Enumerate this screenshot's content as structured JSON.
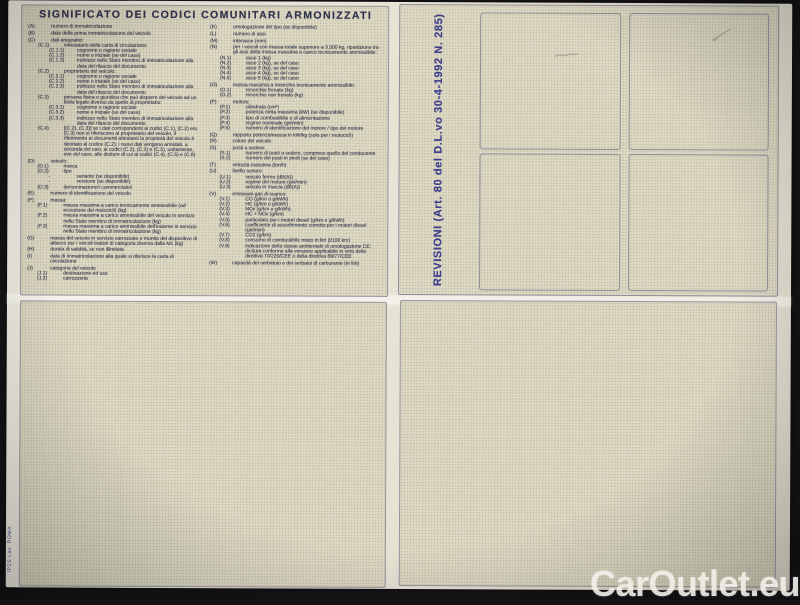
{
  "legend": {
    "title": "SIGNIFICATO DEI CODICI COMUNITARI ARMONIZZATI",
    "left_column": [
      {
        "code": "(A)",
        "text": "numero di immatricolazione",
        "indent": 0
      },
      {
        "code": "(B)",
        "text": "data della prima immatricolazione del veicolo",
        "indent": 0
      },
      {
        "code": "(C)",
        "text": "dati anagrafici:",
        "indent": 0
      },
      {
        "code": "(C.1)",
        "text": "intestatario della carta di circolazione:",
        "indent": 1
      },
      {
        "code": "(C.1.1)",
        "text": "cognome o ragione sociale",
        "indent": 2
      },
      {
        "code": "(C.1.2)",
        "text": "nome o iniziale (se del caso)",
        "indent": 2
      },
      {
        "code": "(C.1.3)",
        "text": "indirizzo nello Stato membro di immatricolazione alla data del rilascio del documento",
        "indent": 2
      },
      {
        "code": "(C.2)",
        "text": "proprietario del veicolo:",
        "indent": 1
      },
      {
        "code": "(C.2.1)",
        "text": "cognome o ragione sociale",
        "indent": 2
      },
      {
        "code": "(C.2.2)",
        "text": "nome o iniziale (se del caso)",
        "indent": 2
      },
      {
        "code": "(C.2.3)",
        "text": "indirizzo nello Stato membro di immatricolazione alla data del rilascio del documento",
        "indent": 2
      },
      {
        "code": "(C.3)",
        "text": "persona fisica o giuridica che può disporre del veicolo ad un titolo legale diverso da quello di proprietario:",
        "indent": 1
      },
      {
        "code": "(C.3.1)",
        "text": "cognome o ragione sociale",
        "indent": 2
      },
      {
        "code": "(C.3.2)",
        "text": "nome o iniziale (se del caso)",
        "indent": 2
      },
      {
        "code": "(C.3.3)",
        "text": "indirizzo nello Stato membro di immatricolazione alla data del rilascio del documento",
        "indent": 2
      },
      {
        "code": "(C.4)",
        "text": "[(C.2), (C.3)] se i dati corrispondenti ai codici (C.1), (C.2) e/o (C.3) non si riferiscono al proprietario del veicolo, il riferimento ai documenti attestanti la proprietà del veicolo è riportato al codice (C.2); i nuovi dati vengono annotati, a seconda dei casi, ai codici (C.2), (C.3) e (C.5), unitamente, ove del caso, alle diciture di cui ai codici (C.4), (C.5) e (C.6)",
        "indent": 1
      },
      {
        "code": "(D)",
        "text": "veicolo:",
        "indent": 0
      },
      {
        "code": "(D.1)",
        "text": "marca",
        "indent": 1
      },
      {
        "code": "(D.2)",
        "text": "tipo",
        "indent": 1
      },
      {
        "code": "-",
        "text": "variante (se disponibile)",
        "indent": 2
      },
      {
        "code": "-",
        "text": "versione (se disponibile)",
        "indent": 2
      },
      {
        "code": "(D.3)",
        "text": "denominazione/i commerciale/i",
        "indent": 1
      },
      {
        "code": "(E)",
        "text": "numero di identificazione del veicolo",
        "indent": 0
      },
      {
        "code": "(F)",
        "text": "massa:",
        "indent": 0
      },
      {
        "code": "(F.1)",
        "text": "massa massima a carico tecnicamente ammissibile (ad eccezione dei motocicli) (kg)",
        "indent": 1
      },
      {
        "code": "(F.2)",
        "text": "massa massima a carico ammissibile del veicolo in servizio nello Stato membro di immatricolazione (kg)",
        "indent": 1
      },
      {
        "code": "(F.3)",
        "text": "massa massima a carico ammissibile dell'insieme in servizio nello Stato membro di immatricolazione (kg)",
        "indent": 1
      },
      {
        "code": "(G)",
        "text": "massa del veicolo in servizio carrozzato e munito del dispositivo di attacco per i veicoli trattori di categoria diversa dalla M1 (kg)",
        "indent": 0
      },
      {
        "code": "(H)",
        "text": "durata di validità, se non illimitata",
        "indent": 0
      },
      {
        "code": "(I)",
        "text": "data di immatricolazione alla quale si riferisce la carta di circolazione",
        "indent": 0
      },
      {
        "code": "(J)",
        "text": "categoria del veicolo",
        "indent": 0
      },
      {
        "code": "(J.1)",
        "text": "destinazione ed uso",
        "indent": 1
      },
      {
        "code": "(J.2)",
        "text": "carrozzeria",
        "indent": 1
      }
    ],
    "right_column": [
      {
        "code": "(K)",
        "text": "omologazione del tipo (se disponibile)",
        "indent": 0
      },
      {
        "code": "(L)",
        "text": "numero di assi",
        "indent": 0
      },
      {
        "code": "(M)",
        "text": "interasse (mm)",
        "indent": 0
      },
      {
        "code": "(N)",
        "text": "per i veicoli con massa totale superiore a 3.500 kg, ripartizione tra gli assi della massa massima a carico tecnicamente ammissibile:",
        "indent": 0
      },
      {
        "code": "(N.1)",
        "text": "asse 1 (kg)",
        "indent": 1
      },
      {
        "code": "(N.2)",
        "text": "asse 2 (kg), se del caso",
        "indent": 1
      },
      {
        "code": "(N.3)",
        "text": "asse 3 (kg), se del caso",
        "indent": 1
      },
      {
        "code": "(N.4)",
        "text": "asse 4 (kg), se del caso",
        "indent": 1
      },
      {
        "code": "(N.5)",
        "text": "asse 5 (kg), se del caso",
        "indent": 1
      },
      {
        "code": "(O)",
        "text": "massa massima a rimorchio tecnicamente ammissibile:",
        "indent": 0
      },
      {
        "code": "(O.1)",
        "text": "rimorchio frenato (kg)",
        "indent": 1
      },
      {
        "code": "(O.2)",
        "text": "rimorchio non frenato (kg)",
        "indent": 1
      },
      {
        "code": "(P)",
        "text": "motore:",
        "indent": 0
      },
      {
        "code": "(P.1)",
        "text": "cilindrata (cm³)",
        "indent": 1
      },
      {
        "code": "(P.2)",
        "text": "potenza netta massima (kW) (se disponibile)",
        "indent": 1
      },
      {
        "code": "(P.3)",
        "text": "tipo di combustibile o di alimentazione",
        "indent": 1
      },
      {
        "code": "(P.4)",
        "text": "regime nominale (giri/min)",
        "indent": 1
      },
      {
        "code": "(P.5)",
        "text": "numero di identificazione del motore / tipo del motore",
        "indent": 1
      },
      {
        "code": "(Q)",
        "text": "rapporto potenza/massa in kW/kg (solo per i motocicli)",
        "indent": 0
      },
      {
        "code": "(R)",
        "text": "colore del veicolo",
        "indent": 0
      },
      {
        "code": "(S)",
        "text": "posti a sedere:",
        "indent": 0
      },
      {
        "code": "(S.1)",
        "text": "numero di posti a sedere, compreso quello del conducente",
        "indent": 1
      },
      {
        "code": "(S.2)",
        "text": "numero dei posti in piedi (se del caso)",
        "indent": 1
      },
      {
        "code": "(T)",
        "text": "velocità massima (km/h)",
        "indent": 0
      },
      {
        "code": "(U)",
        "text": "livello sonoro:",
        "indent": 0
      },
      {
        "code": "(U.1)",
        "text": "veicolo fermo (dB(A))",
        "indent": 1
      },
      {
        "code": "(U.2)",
        "text": "regime del motore (giri/min)",
        "indent": 1
      },
      {
        "code": "(U.3)",
        "text": "veicolo in marcia (dB(A))",
        "indent": 1
      },
      {
        "code": "(V)",
        "text": "emissioni gas di scarico:",
        "indent": 0
      },
      {
        "code": "(V.1)",
        "text": "CO (g/km o g/kWh)",
        "indent": 1
      },
      {
        "code": "(V.2)",
        "text": "HC (g/km o g/kWh)",
        "indent": 1
      },
      {
        "code": "(V.3)",
        "text": "NOx (g/km o g/kWh)",
        "indent": 1
      },
      {
        "code": "(V.4)",
        "text": "HC + NOx (g/km)",
        "indent": 1
      },
      {
        "code": "(V.5)",
        "text": "particolato per i motori diesel (g/km o g/kWh)",
        "indent": 1
      },
      {
        "code": "(V.6)",
        "text": "coefficiente di assorbimento corretto per i motori diesel (giri/min)",
        "indent": 1
      },
      {
        "code": "(V.7)",
        "text": "CO2 (g/km)",
        "indent": 1
      },
      {
        "code": "(V.8)",
        "text": "consumo di combustibile misto in litri (l/100 km)",
        "indent": 1
      },
      {
        "code": "(V.9)",
        "text": "indicazione della classe ambientale di omologazione CE: dicitura conforme alla versione applicabile in virtù della direttiva 70/220/CEE o della direttiva 88/77/CEE",
        "indent": 1
      },
      {
        "code": "(W)",
        "text": "capacità del serbatoio o dei serbatoi di carburante (in litri)",
        "indent": 0
      }
    ]
  },
  "revisioni": {
    "label": "REVISIONI (Art. 80 del D.L.vo 30-4-1992 N. 285)",
    "label_color": "#3d3d8c"
  },
  "imprint": {
    "text": "IPZS Lav. ROMA"
  },
  "watermark": {
    "text": "CarOutlet.eu"
  }
}
